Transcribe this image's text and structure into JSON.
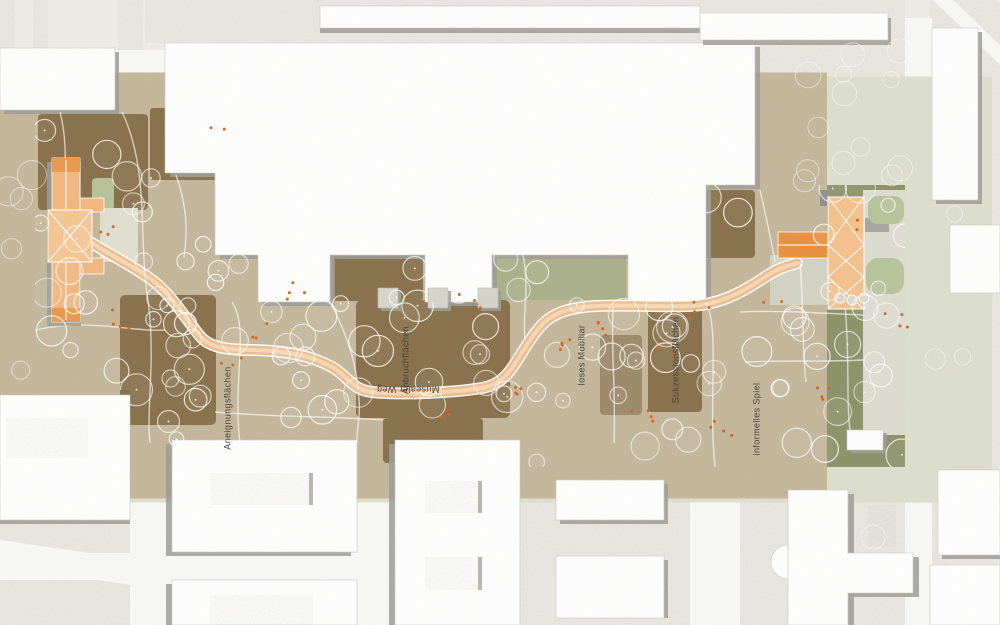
{
  "map": {
    "type": "landscape-architecture-site-plan",
    "labels": [
      {
        "id": "aneignungsflaechen",
        "text": "Aneignungsflächen"
      },
      {
        "id": "abbruchflaechen",
        "text": "Abbruchflächen"
      },
      {
        "id": "musealer-weg",
        "text": "Musealer Weg"
      },
      {
        "id": "loses-mobiliar",
        "text": "loses Mobiliar"
      },
      {
        "id": "sukzessionsflaechen",
        "text": "Sukzessionsflächen"
      },
      {
        "id": "informelles-spiel",
        "text": "informelles Spiel"
      }
    ],
    "colors": {
      "paper": "#ecebe6",
      "context_gray": "#dcdbd2",
      "road_white": "#f8f8f4",
      "park_green": "#a3a884",
      "lawn_green": "#b7c199",
      "succession_brown": "#b3a07e",
      "path_orange": "#ecbd92",
      "path_orange_light": "#f6d9b6",
      "building_orange": "#f2b87f",
      "building_orange_dark": "#ea9a4e",
      "building_orange_pale": "#f5c693",
      "accent_dot_orange": "#d96417",
      "building_white": "#ffffff",
      "shadow_gray": "#9e9d97",
      "label_text": "#45433c"
    }
  }
}
